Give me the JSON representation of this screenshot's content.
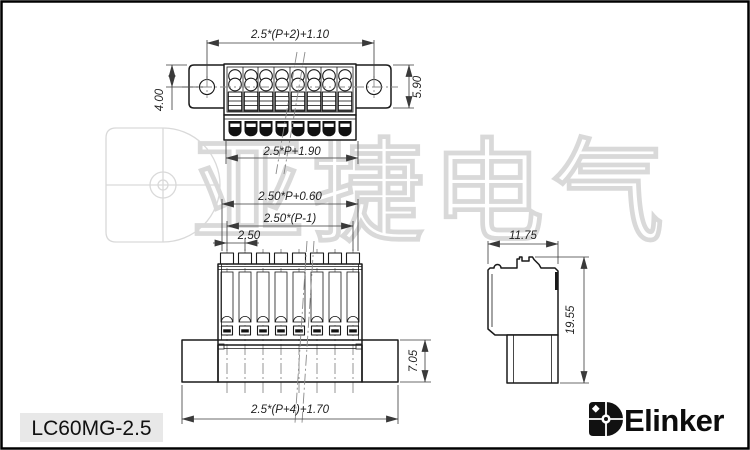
{
  "drawing": {
    "watermark_text": "亚捷电气",
    "part_label": "LC60MG-2.5",
    "brand_name": "Elinker",
    "dimensions": {
      "top_view": {
        "overall_width": "2.5*(P+2)+1.10",
        "flange_hole_offset": "4.00",
        "flange_height": "5.90",
        "body_width": "2.5*P+1.90"
      },
      "front_view": {
        "pin_row_width": "2.50*P+0.60",
        "pin_span": "2.50*(P-1)",
        "pitch": "2.50",
        "base_height": "7.05",
        "overall_width": "2.5*(P+4)+1.70"
      },
      "side_view": {
        "depth": "11.75",
        "height": "19.55"
      }
    },
    "colors": {
      "line": "#1a1a1a",
      "dim_text": "#1f1f1f",
      "watermark": "#d9d9d9",
      "label_bg": "#e8e8e8",
      "brand": "#0d0d0d"
    }
  }
}
